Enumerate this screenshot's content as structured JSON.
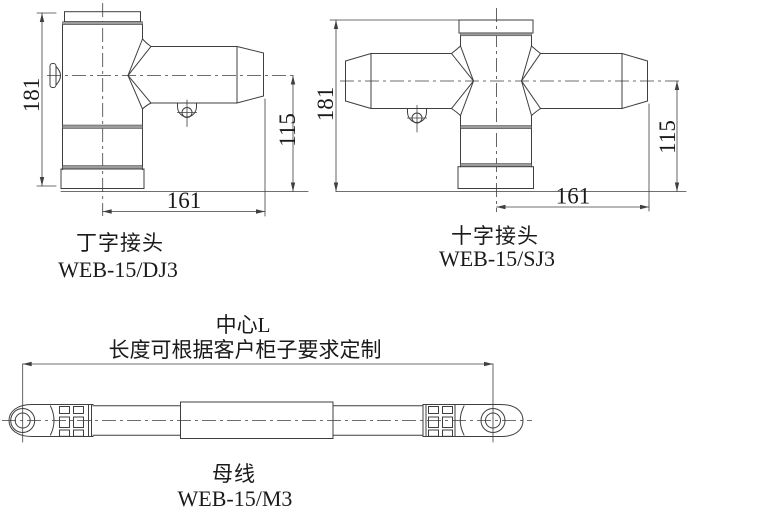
{
  "colors": {
    "line": "#3f3f3f",
    "band": "#9c9c9c",
    "text": "#1a1a1a",
    "background": "#ffffff"
  },
  "drawings": {
    "tee": {
      "title": "丁字接头",
      "model": "WEB-15/DJ3",
      "dim_height": "181",
      "dim_center_height": "115",
      "dim_length": "161"
    },
    "cross": {
      "title": "十字接头",
      "model": "WEB-15/SJ3",
      "dim_height": "181",
      "dim_center_height": "115",
      "dim_length": "161"
    },
    "busbar": {
      "title": "母线",
      "model": "WEB-15/M3",
      "dim_note_line1": "中心L",
      "dim_note_line2": "长度可根据客户柜子要求定制"
    }
  }
}
